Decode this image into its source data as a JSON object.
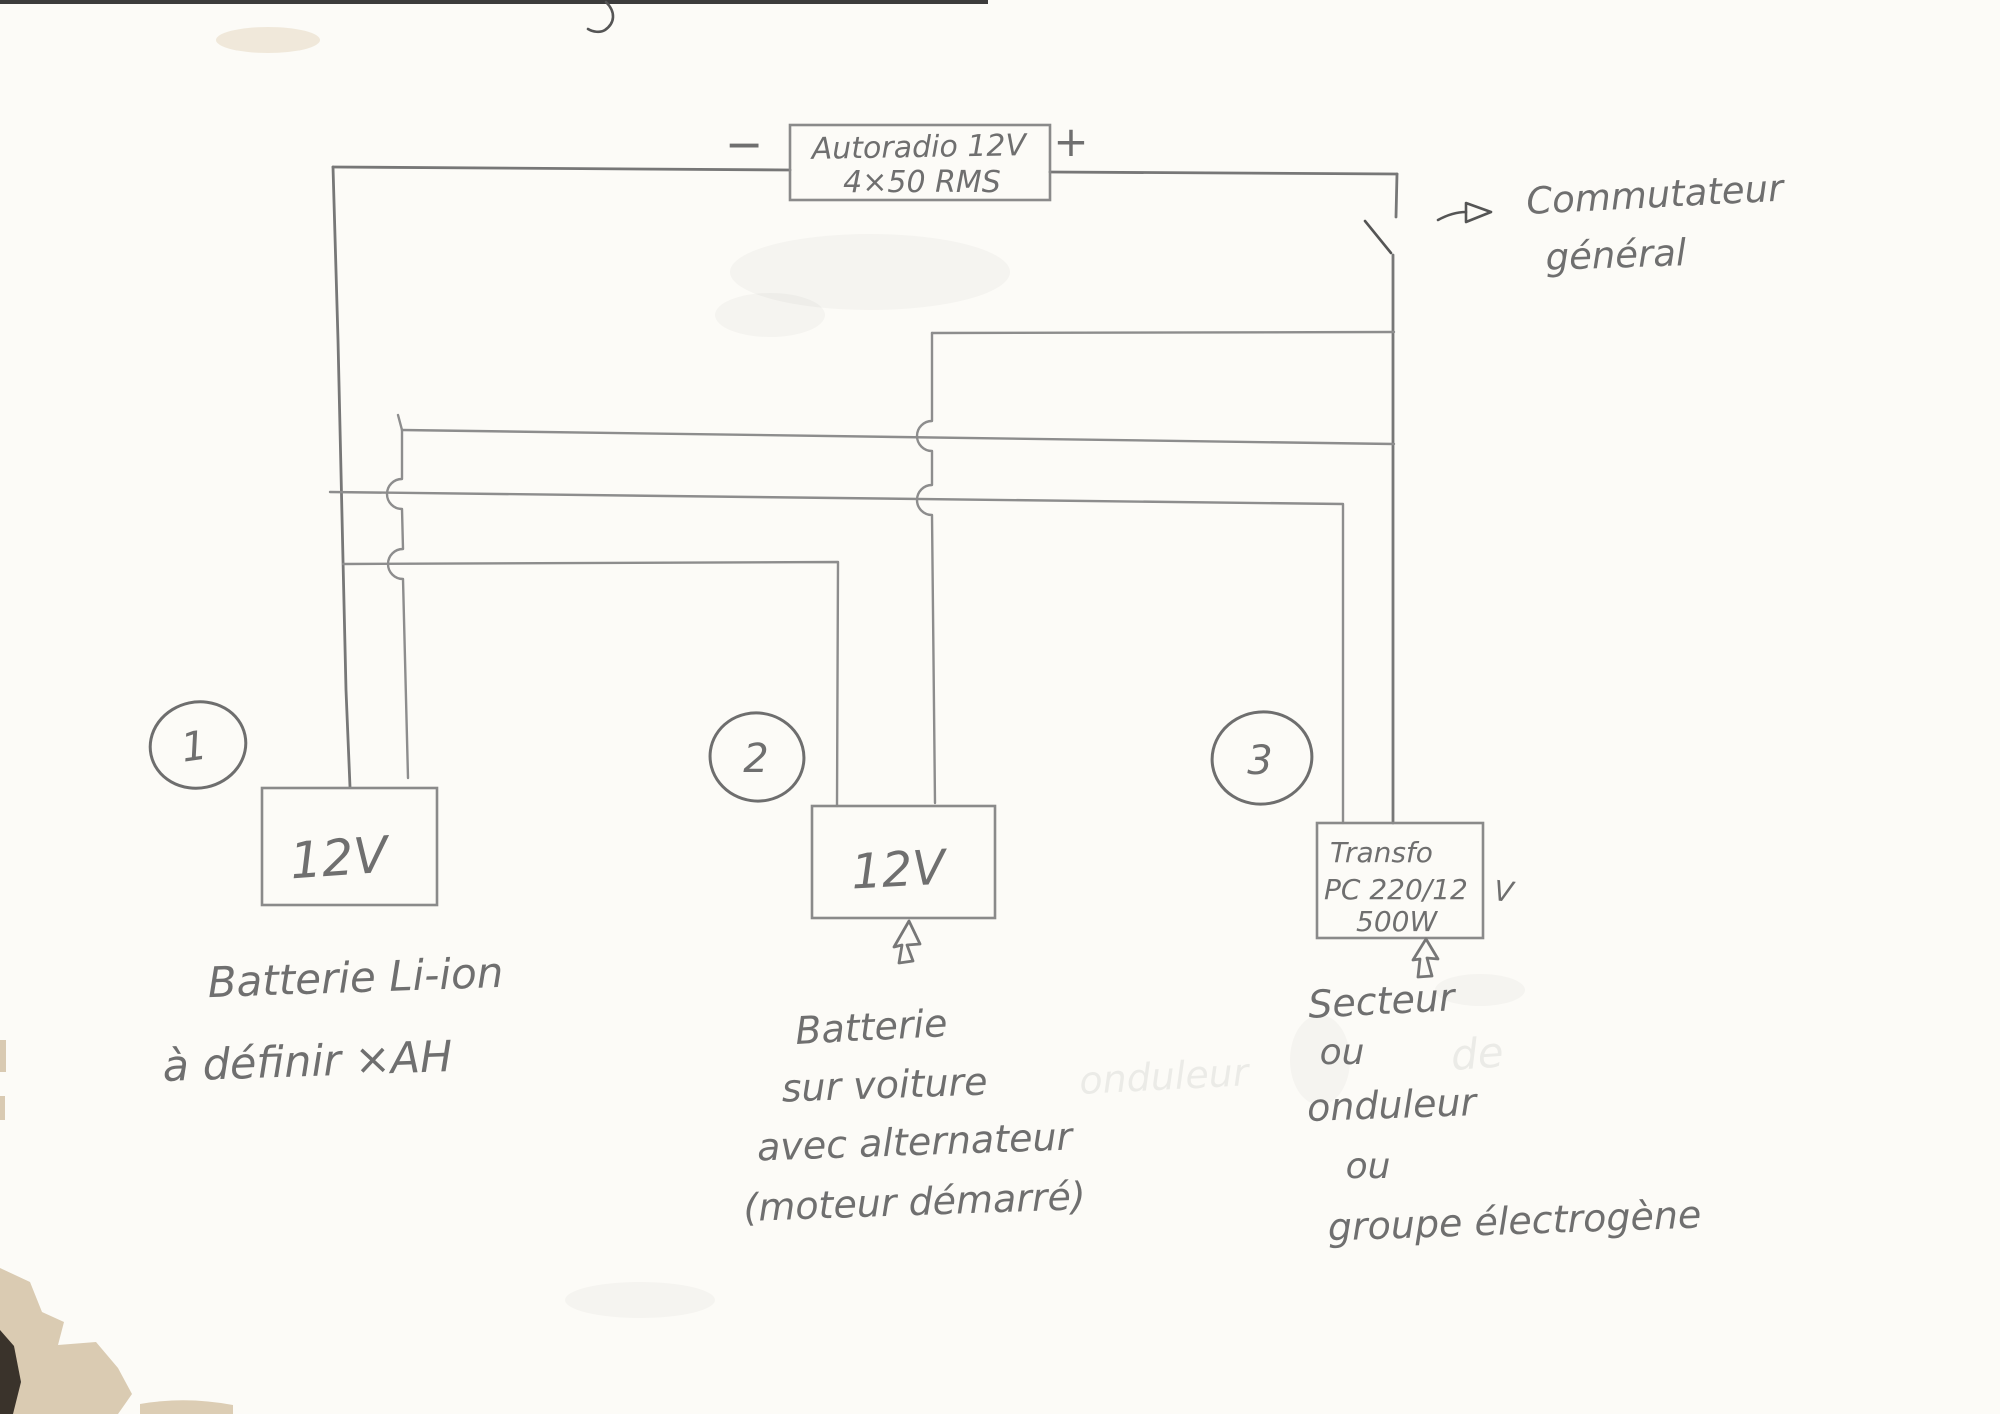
{
  "colors": {
    "paper": "#fcfbf7",
    "pencil": "#8d8d8d",
    "pencil_dark": "#6f6f6f",
    "pen": "#555555",
    "stain_tan": "#d8c8ae",
    "stain_dark": "#3a332b"
  },
  "head_unit": {
    "label_line1": "Autoradio 12V",
    "label_line2": "4×50 RMS",
    "minus": "−",
    "plus": "+"
  },
  "switch": {
    "label_line1": "Commutateur",
    "label_line2": "général"
  },
  "sources": [
    {
      "number": "1",
      "box_label": "12V",
      "caption_line1": "Batterie Li-ion",
      "caption_line2": "à définir ×AH"
    },
    {
      "number": "2",
      "box_label": "12V",
      "caption_line1": "Batterie",
      "caption_line2": "sur voiture",
      "caption_line3": "avec alternateur",
      "caption_line4": "(moteur démarré)"
    },
    {
      "number": "3",
      "box_line1": "Transfo",
      "box_line2": "PC 220/12",
      "box_line3": "500W",
      "unit_outside": "V",
      "caption_line1": "Secteur",
      "caption_line2": "ou",
      "caption_line3": "onduleur",
      "caption_line4": "ou",
      "caption_line5": "groupe électrogène"
    }
  ],
  "erased_ghost": {
    "word1": "onduleur",
    "word2": "de"
  }
}
